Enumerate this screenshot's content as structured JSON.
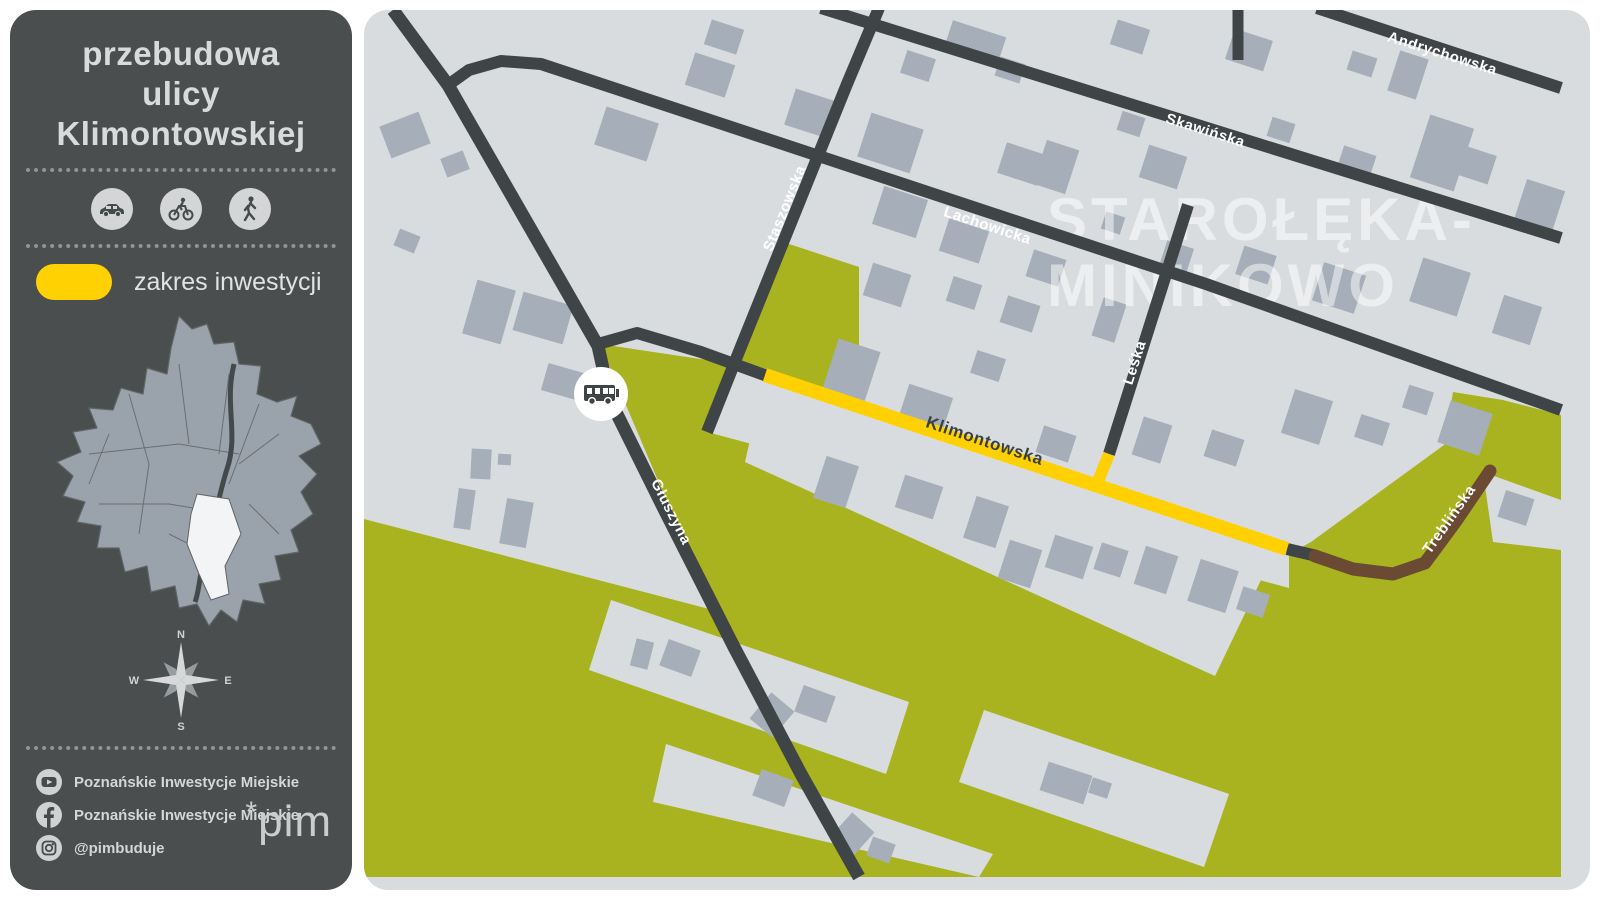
{
  "sidebar": {
    "title_lines": [
      "przebudowa",
      "ulicy",
      "Klimontowskiej"
    ],
    "modes": [
      "car",
      "bicycle",
      "pedestrian"
    ],
    "legend": {
      "label": "zakres inwestycji",
      "swatch_color": "#ffd103"
    },
    "compass": {
      "n": "N",
      "e": "E",
      "s": "S",
      "w": "W"
    },
    "social": [
      {
        "network": "youtube",
        "label": "Poznańskie Inwestycje Miejskie"
      },
      {
        "network": "facebook",
        "label": "Poznańskie Inwestycje Miejskie"
      },
      {
        "network": "instagram",
        "label": "@pimbuduje"
      }
    ],
    "logo": {
      "asterisk": "*",
      "text": "pim"
    }
  },
  "map": {
    "watermark": {
      "lines": [
        "STAROŁĘKA-",
        "MINIKOWO"
      ],
      "x": 1046,
      "y": [
        238,
        304
      ],
      "size": 60
    },
    "colors": {
      "bg": "#d9dcde",
      "building": "#a6afb9",
      "road": "#3f4446",
      "green": "#a9b31f",
      "yellow": "#ffd103",
      "brown": "#6b4a33",
      "label_light": "#ffffff",
      "label_dark": "#3a4042"
    },
    "greens": [
      "779,239 858,265 858,401 768,372 733,362 741,351",
      "599,342 733,362 706,430 1288,586 1288,875 363,875 363,517 712,608",
      "1288,875 1560,875 1560,413 1502,398 1452,390 1443,443 1310,540 1288,552"
    ],
    "gray_strips": [
      "762,381 1272,553 1214,674 744,460",
      "610,598 908,700 885,772 588,668",
      "665,742 992,852 978,875 652,800",
      "983,708 1228,792 1203,865 958,780",
      "1482,470 1560,498 1560,548 1492,540"
    ],
    "buildings": [
      [
        383,
        116,
        42,
        34,
        -21
      ],
      [
        442,
        152,
        24,
        20,
        -21
      ],
      [
        395,
        230,
        22,
        18,
        22
      ],
      [
        468,
        282,
        40,
        56,
        16
      ],
      [
        516,
        296,
        52,
        40,
        16
      ],
      [
        543,
        366,
        40,
        28,
        16
      ],
      [
        470,
        447,
        20,
        30,
        3
      ],
      [
        497,
        452,
        13,
        11,
        3
      ],
      [
        455,
        487,
        17,
        40,
        8
      ],
      [
        502,
        498,
        27,
        46,
        10
      ],
      [
        598,
        112,
        55,
        40,
        18
      ],
      [
        688,
        56,
        42,
        34,
        18
      ],
      [
        706,
        22,
        34,
        26,
        18
      ],
      [
        788,
        92,
        42,
        38,
        18
      ],
      [
        862,
        118,
        55,
        46,
        18
      ],
      [
        876,
        190,
        46,
        40,
        18
      ],
      [
        946,
        26,
        56,
        30,
        18
      ],
      [
        902,
        52,
        30,
        24,
        18
      ],
      [
        996,
        58,
        26,
        20,
        18
      ],
      [
        1000,
        146,
        42,
        32,
        18
      ],
      [
        1038,
        142,
        34,
        46,
        18
      ],
      [
        1112,
        22,
        34,
        26,
        18
      ],
      [
        1118,
        112,
        24,
        20,
        18
      ],
      [
        1142,
        148,
        40,
        34,
        18
      ],
      [
        1228,
        32,
        40,
        32,
        18
      ],
      [
        1268,
        118,
        24,
        20,
        18
      ],
      [
        1348,
        52,
        26,
        20,
        18
      ],
      [
        1392,
        52,
        30,
        42,
        18
      ],
      [
        1418,
        118,
        46,
        66,
        18
      ],
      [
        1338,
        148,
        34,
        28,
        18
      ],
      [
        1458,
        148,
        34,
        30,
        18
      ],
      [
        1518,
        182,
        40,
        46,
        18
      ],
      [
        942,
        222,
        42,
        34,
        18
      ],
      [
        1028,
        252,
        34,
        28,
        18
      ],
      [
        1102,
        212,
        20,
        18,
        18
      ],
      [
        1162,
        242,
        28,
        24,
        18
      ],
      [
        1238,
        248,
        34,
        30,
        18
      ],
      [
        1316,
        266,
        44,
        40,
        18
      ],
      [
        1414,
        262,
        50,
        46,
        18
      ],
      [
        1496,
        298,
        40,
        40,
        18
      ],
      [
        1002,
        298,
        34,
        28,
        18
      ],
      [
        1096,
        298,
        24,
        40,
        18
      ],
      [
        866,
        266,
        40,
        34,
        18
      ],
      [
        828,
        342,
        44,
        56,
        18
      ],
      [
        902,
        388,
        46,
        34,
        18
      ],
      [
        972,
        352,
        30,
        24,
        18
      ],
      [
        1038,
        428,
        34,
        28,
        18
      ],
      [
        1136,
        418,
        30,
        40,
        18
      ],
      [
        1206,
        432,
        34,
        28,
        18
      ],
      [
        1286,
        392,
        40,
        46,
        18
      ],
      [
        1356,
        416,
        30,
        24,
        18
      ],
      [
        1442,
        404,
        44,
        44,
        18
      ],
      [
        1404,
        386,
        26,
        24,
        18
      ],
      [
        948,
        278,
        30,
        26,
        18
      ],
      [
        818,
        458,
        34,
        44,
        18
      ],
      [
        898,
        478,
        40,
        34,
        18
      ],
      [
        968,
        498,
        34,
        44,
        18
      ],
      [
        1002,
        542,
        34,
        40,
        18
      ],
      [
        1048,
        538,
        40,
        34,
        18
      ],
      [
        1096,
        544,
        28,
        28,
        18
      ],
      [
        1138,
        548,
        34,
        40,
        18
      ],
      [
        1192,
        562,
        40,
        44,
        18
      ],
      [
        1238,
        588,
        28,
        24,
        18
      ],
      [
        632,
        638,
        18,
        28,
        14
      ],
      [
        662,
        642,
        34,
        28,
        20
      ],
      [
        756,
        696,
        30,
        34,
        40
      ],
      [
        797,
        688,
        34,
        28,
        20
      ],
      [
        755,
        772,
        34,
        28,
        20
      ],
      [
        836,
        816,
        30,
        34,
        42
      ],
      [
        868,
        838,
        24,
        20,
        20
      ],
      [
        1042,
        766,
        46,
        30,
        18
      ],
      [
        1089,
        778,
        20,
        16,
        18
      ],
      [
        1500,
        492,
        30,
        28,
        18
      ]
    ],
    "streets": [
      {
        "id": "gluszyna",
        "color": "road",
        "width": 13,
        "points": [
          [
            392,
            8
          ],
          [
            447,
            83
          ],
          [
            597,
            344
          ],
          [
            609,
            398
          ],
          [
            662,
            505
          ],
          [
            733,
            645
          ],
          [
            800,
            772
          ],
          [
            858,
            875
          ]
        ],
        "label": {
          "text": "Głuszyna",
          "x": 666,
          "y": 512,
          "rot": 63,
          "size": 15,
          "color": "label_light"
        }
      },
      {
        "id": "lachowicka",
        "color": "road",
        "width": 12,
        "points": [
          [
            447,
            83
          ],
          [
            468,
            68
          ],
          [
            500,
            59
          ],
          [
            540,
            62
          ],
          [
            860,
            168
          ],
          [
            1205,
            282
          ],
          [
            1560,
            408
          ]
        ],
        "label": {
          "text": "Lachowicka",
          "x": 985,
          "y": 228,
          "rot": 18.3,
          "size": 15,
          "color": "label_light"
        }
      },
      {
        "id": "skawinska",
        "color": "road",
        "width": 12,
        "points": [
          [
            820,
            6
          ],
          [
            1560,
            236
          ]
        ],
        "label": {
          "text": "Skawińska",
          "x": 1203,
          "y": 133,
          "rot": 17.5,
          "size": 15,
          "color": "label_light"
        }
      },
      {
        "id": "andrychowska",
        "color": "road",
        "width": 12,
        "points": [
          [
            1316,
            6
          ],
          [
            1560,
            86
          ]
        ],
        "label": {
          "text": "Andrychowska",
          "x": 1440,
          "y": 56,
          "rot": 17.5,
          "size": 15,
          "color": "label_light"
        }
      },
      {
        "id": "north-stub",
        "color": "road",
        "width": 11,
        "points": [
          [
            1237,
            6
          ],
          [
            1237,
            58
          ]
        ]
      },
      {
        "id": "staszowska",
        "color": "road",
        "width": 12,
        "points": [
          [
            878,
            6
          ],
          [
            846,
            82
          ],
          [
            737,
            352
          ],
          [
            706,
            430
          ]
        ],
        "label": {
          "text": "Staszowska",
          "x": 788,
          "y": 208,
          "rot": -68,
          "size": 15,
          "color": "label_light"
        }
      },
      {
        "id": "leska",
        "color": "road",
        "width": 12,
        "points": [
          [
            1187,
            203
          ],
          [
            1108,
            452
          ]
        ],
        "label": {
          "text": "Leśka",
          "x": 1138,
          "y": 362,
          "rot": -72,
          "size": 15,
          "color": "label_light"
        }
      },
      {
        "id": "junction-link",
        "color": "road",
        "width": 12,
        "points": [
          [
            597,
            342
          ],
          [
            636,
            331
          ],
          [
            700,
            350
          ],
          [
            766,
            374
          ]
        ]
      },
      {
        "id": "treblinska-connector",
        "color": "road",
        "width": 12,
        "points": [
          [
            1286,
            547
          ],
          [
            1316,
            554
          ]
        ]
      },
      {
        "id": "klimontowska",
        "color": "yellow",
        "width": 14,
        "points": [
          [
            764,
            373
          ],
          [
            1286,
            547
          ]
        ],
        "label": {
          "text": "Klimontowska",
          "x": 982,
          "y": 444,
          "rot": 18.3,
          "size": 17,
          "color": "label_dark"
        }
      },
      {
        "id": "leska-stub",
        "color": "yellow",
        "width": 12,
        "points": [
          [
            1108,
            452
          ],
          [
            1094,
            487
          ]
        ]
      },
      {
        "id": "treblinska",
        "color": "brown",
        "width": 13,
        "points": [
          [
            1314,
            554
          ],
          [
            1352,
            567
          ],
          [
            1392,
            572
          ],
          [
            1424,
            561
          ],
          [
            1455,
            519
          ],
          [
            1489,
            469
          ]
        ],
        "label": {
          "text": "Treblińska",
          "x": 1452,
          "y": 520,
          "rot": -55,
          "size": 15,
          "color": "label_light"
        }
      }
    ],
    "bus_stop": {
      "x": 600,
      "y": 392,
      "r": 27
    }
  }
}
